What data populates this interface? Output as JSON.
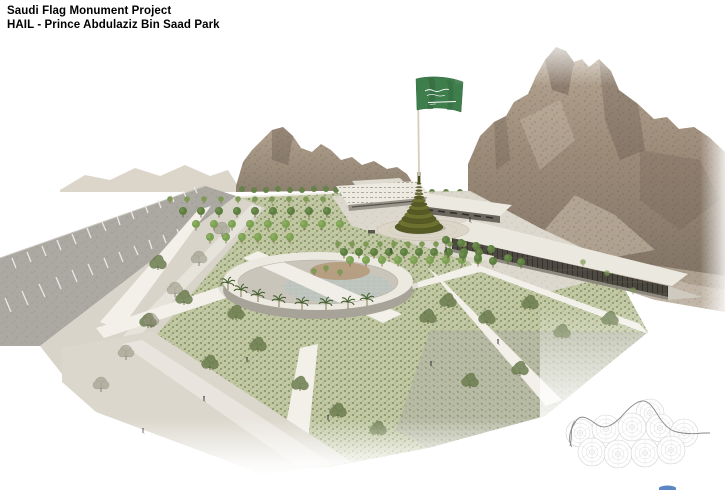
{
  "header": {
    "line1": "Saudi Flag Monument Project",
    "line2": "HAIL - Prince Abdulaziz Bin Saad Park"
  },
  "scene": {
    "type": "architectural-rendering",
    "subject": "Aerial perspective rendering of a park with a Saudi flag monument on a spiral base, rocky mountains behind, an elliptical ring building, tree-lined lawns, diagonal pedestrian paths and a parking road",
    "colors": {
      "flag_green": "#3e7d4c",
      "monument_olive": "#6d7130",
      "lawn_green": "#c1c8a3",
      "mountain_brown": "#9b8a78",
      "path_white": "#f2f0e9",
      "road_gray": "#aca9a2",
      "keyplan_gray": "#d0d0d0",
      "logo_blue": "#5b87c5"
    },
    "elements": [
      "saudi-flag",
      "flag-monument-spiral-base",
      "circular-ring-building",
      "visitor-buildings",
      "mountain-backdrop",
      "parking-road",
      "lawn-and-paths",
      "key-plan-diagram",
      "blue-logo-fragment"
    ]
  }
}
